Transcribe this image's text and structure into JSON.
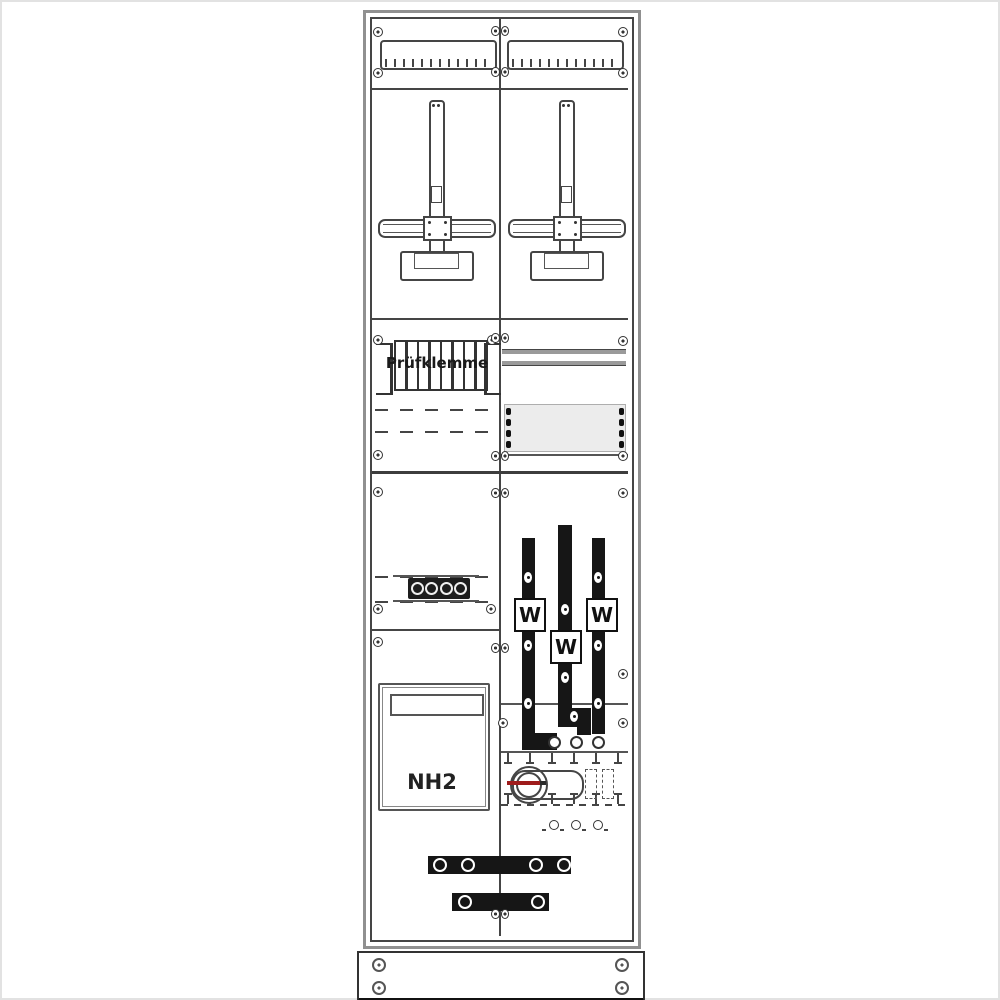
{
  "cabinet": {
    "test_terminal_label": "Prüfklemme",
    "fuse_label": "NH2",
    "meter_labels": [
      "W",
      "W",
      "W"
    ]
  },
  "colors": {
    "line": "#454545",
    "busbar": "#161616",
    "switch_indicator": "#9e1b1b",
    "panel_fill": "#ececec",
    "frame_gray": "#909090"
  },
  "icons": {
    "screw": "screw-icon",
    "terminal_ring": "terminal-ring-icon"
  }
}
